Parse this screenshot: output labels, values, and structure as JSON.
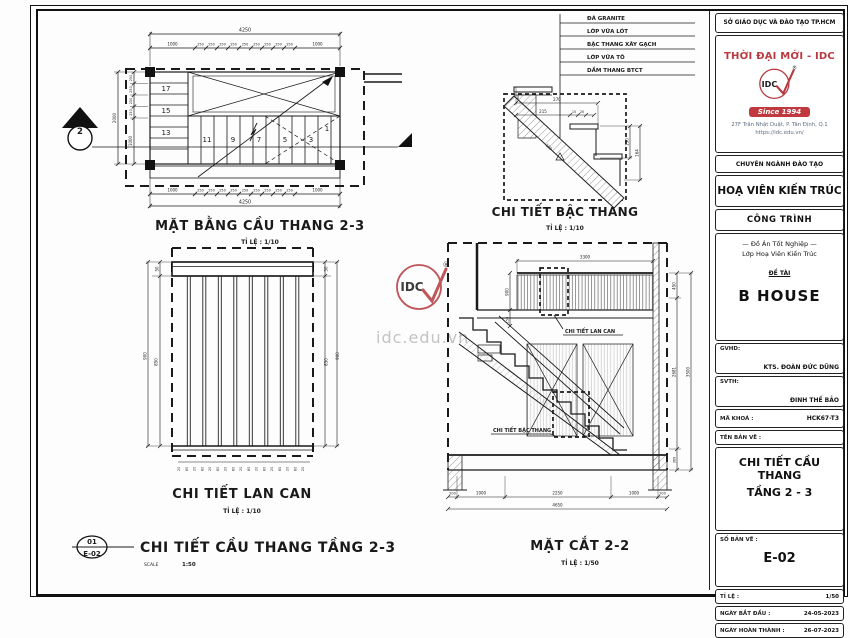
{
  "watermark": {
    "url": "idc.edu.vn"
  },
  "title_block": {
    "dept": "SỞ GIÁO DỤC VÀ ĐÀO TẠO TP.HCM",
    "brand": "THỜI ĐẠI MỚI - IDC",
    "logo_text": "IDC",
    "registered_mark": "®",
    "since": "Since 1994",
    "address_line1": "27F Trần Nhật Duật, P. Tân Định, Q.1",
    "address_line2": "https://idc.edu.vn/",
    "training": "CHUYÊN NGÀNH ĐÀO TẠO",
    "major": "HOẠ VIÊN KIẾN TRÚC",
    "project_header": "CÔNG TRÌNH",
    "project_line1": "— Đồ Án Tốt Nghiệp —",
    "project_line2": "Lớp Hoạ Viên Kiến Trúc",
    "topic_label": "ĐỀ TÀI",
    "topic_value": "B HOUSE",
    "gvhd_label": "GVHD:",
    "gvhd_value": "KTS. ĐOÀN ĐỨC DŨNG",
    "svth_label": "SVTH:",
    "svth_value": "ĐINH THẾ BẢO",
    "code_label": "MÃ KHOÁ :",
    "code_value": "HCK67-T3",
    "sheet_name_label": "TÊN BẢN VẼ :",
    "sheet_name_line1": "CHI TIẾT CẦU THANG",
    "sheet_name_line2": "TẦNG 2 - 3",
    "sheet_no_label": "SỐ BẢN VẼ :",
    "sheet_no_value": "E-02",
    "scale_label": "TỈ LỆ :",
    "scale_value": "1/50",
    "date_start_label": "NGÀY BẮT ĐẦU :",
    "date_start_value": "24-05-2023",
    "date_end_label": "NGÀY HOÀN THÀNH :",
    "date_end_value": "26-07-2023"
  },
  "footer": {
    "detail_number": "01",
    "sheet": "E-02",
    "title": "CHI TIẾT CẦU THANG TẦNG 2-3",
    "scale_label": "SCALE",
    "scale_value": "1:50"
  },
  "plan": {
    "title": "MẶT BẰNG CẦU THANG 2-3",
    "scale": "TỈ LỆ : 1/10",
    "section_marker": "2",
    "steps_left": [
      "17",
      "15",
      "13"
    ],
    "steps_bottom": [
      "11",
      "9",
      "7",
      "5",
      "3",
      "1"
    ],
    "dim_total": "4250",
    "dim_segs": [
      "1000",
      "250",
      "250",
      "250",
      "250",
      "250",
      "250",
      "250",
      "250",
      "250",
      "1000"
    ],
    "dim_left_segs": [
      "250",
      "250",
      "250",
      "250",
      "1000"
    ],
    "dim_left_total": "2000"
  },
  "step_detail": {
    "title": "CHI TIẾT BẬC THANG",
    "scale": "TỈ LỆ : 1/10",
    "notes": [
      "ĐÁ GRANITE",
      "LỚP VỮA LÓT",
      "BẬC THANG XÂY GẠCH",
      "LỚP VỮA TÔ",
      "DẦM THANG BTCT"
    ],
    "dim_270": "270",
    "dim_215": "215",
    "dim_15": "15",
    "dim_20": "20",
    "dim_150": "150",
    "dim_164": "164",
    "dim_slab": "180"
  },
  "railing": {
    "title": "CHI TIẾT LAN CAN",
    "scale": "TỈ LỆ : 1/10",
    "dim_cap": "50",
    "dim_mid": "850",
    "dim_total": "900",
    "dim_bar": "20",
    "dim_gap": "80"
  },
  "section": {
    "title": "MẶT CẮT 2-2",
    "scale": "TỈ LỆ : 1/50",
    "callout_railing": "CHI TIẾT LAN CAN",
    "callout_step": "CHI TIẾT BẬC THANG",
    "dim_top": "3300",
    "dim_rail": "900",
    "dim_riser": "150",
    "dims_right": [
      "450",
      "2681",
      "369"
    ],
    "dim_right_total": "3500",
    "dims_bottom": [
      "200",
      "1000",
      "2250",
      "1000",
      "200"
    ],
    "dim_bottom_total": "4650"
  }
}
